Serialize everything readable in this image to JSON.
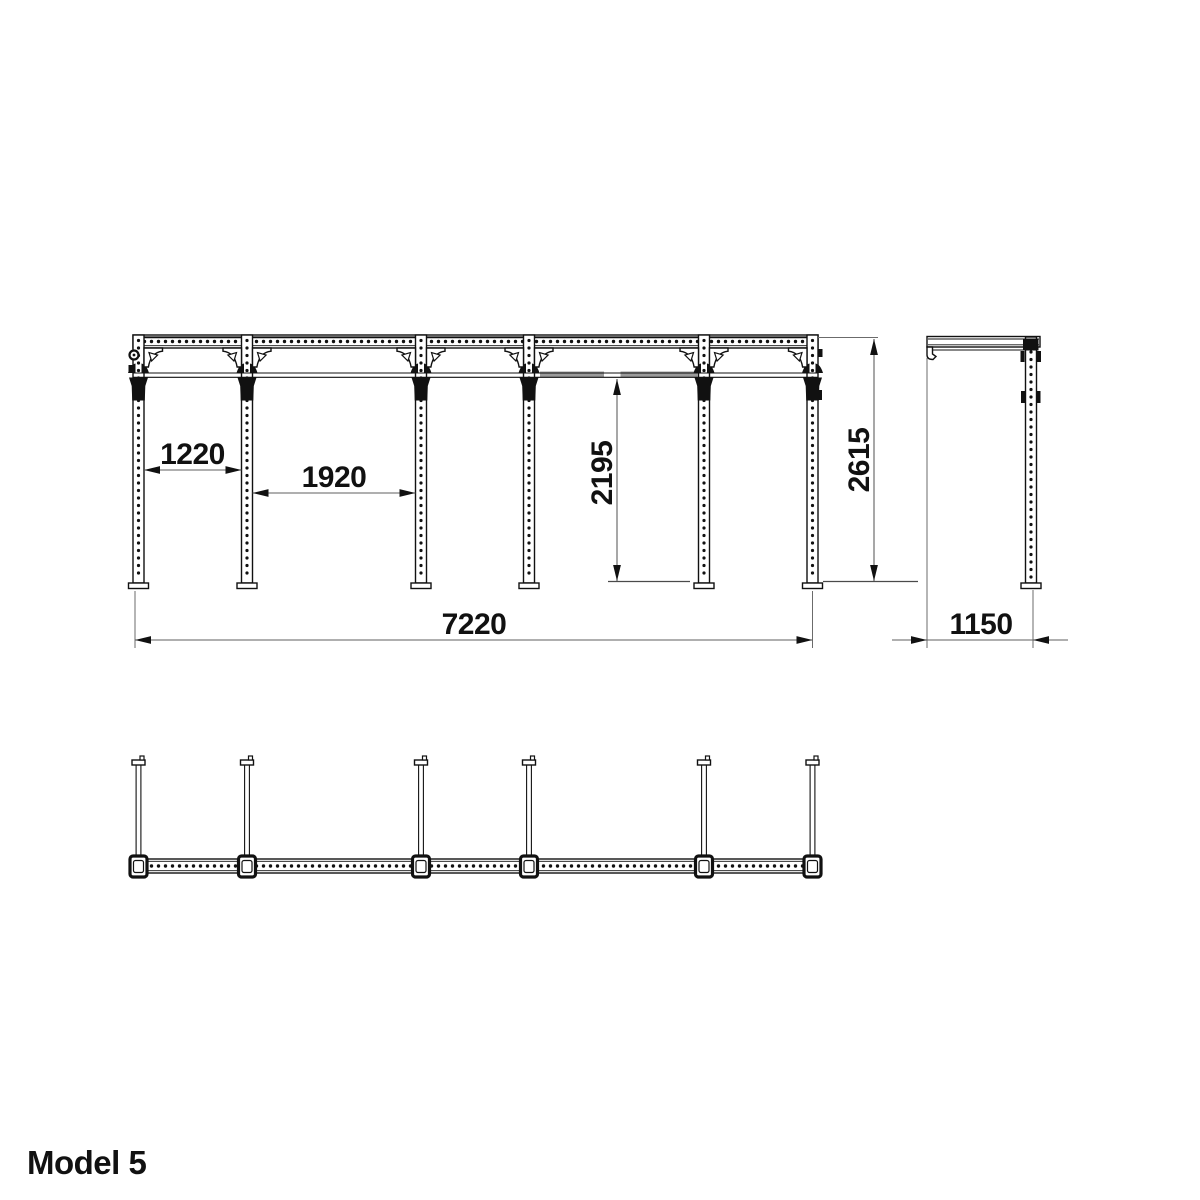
{
  "title": {
    "label": "Model 5"
  },
  "dimensions": {
    "bay1_width": "1220",
    "bay2_width": "1920",
    "bar_height": "2195",
    "overall_height": "2615",
    "overall_width": "7220",
    "overall_depth": "1150"
  },
  "colors": {
    "line": "#111111",
    "dimension_line": "#5f5f5f",
    "knurl_gray": "#9b9b9b",
    "background": "#ffffff"
  }
}
